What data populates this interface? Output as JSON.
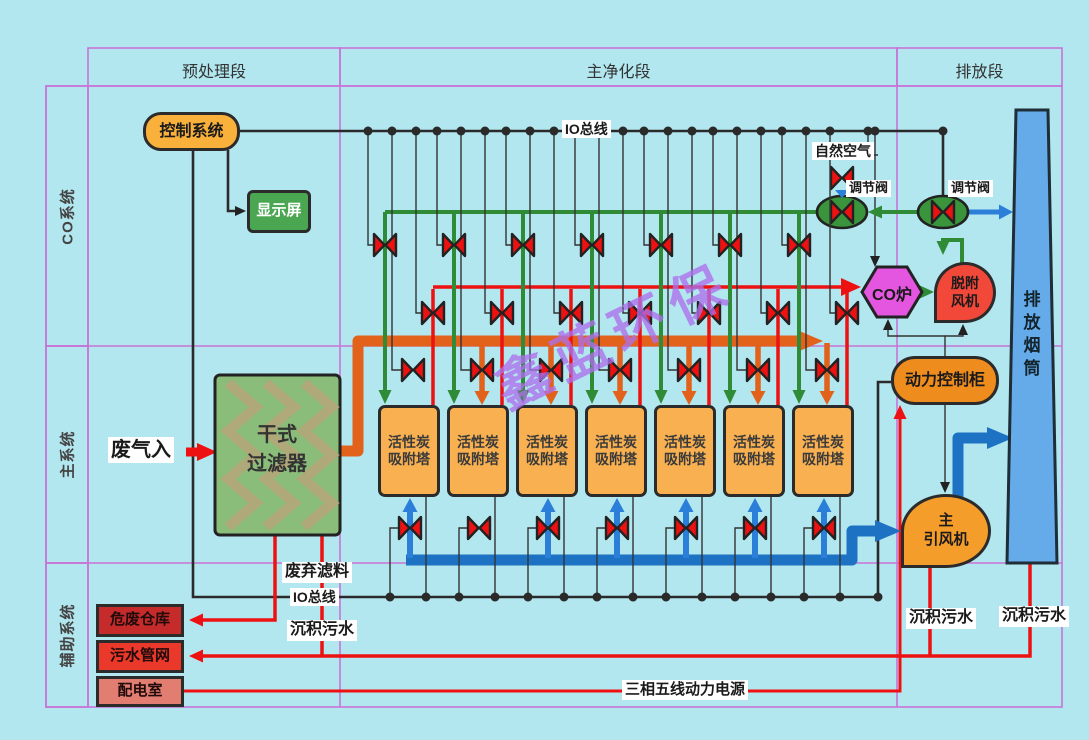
{
  "header": {
    "col1": "预处理段",
    "col2": "主净化段",
    "col3": "排放段"
  },
  "rows": {
    "row1": "CO系统",
    "row2": "主系统",
    "row3": "辅助系统"
  },
  "nodes": {
    "control_system": "控制系统",
    "display_screen": "显示屏",
    "dry_filter_line1": "干式",
    "dry_filter_line2": "过滤器",
    "co_furnace": "CO炉",
    "desorption_fan_line1": "脱附",
    "desorption_fan_line2": "风机",
    "power_cabinet": "动力控制柜",
    "main_fan_line1": "主",
    "main_fan_line2": "引风机",
    "stack": "排放烟筒",
    "hazard_store": "危废仓库",
    "sewage_network": "污水管网",
    "power_room": "配电室"
  },
  "towers": [
    {
      "line1": "活性炭",
      "line2": "吸附塔"
    },
    {
      "line1": "活性炭",
      "line2": "吸附塔"
    },
    {
      "line1": "活性炭",
      "line2": "吸附塔"
    },
    {
      "line1": "活性炭",
      "line2": "吸附塔"
    },
    {
      "line1": "活性炭",
      "line2": "吸附塔"
    },
    {
      "line1": "活性炭",
      "line2": "吸附塔"
    },
    {
      "line1": "活性炭",
      "line2": "吸附塔"
    }
  ],
  "labels": {
    "io_bus_top": "IO总线",
    "io_bus_bottom": "IO总线",
    "natural_air": "自然空气",
    "reg_valve_left": "调节阀",
    "reg_valve_right": "调节阀",
    "waste_gas_in": "废气入",
    "waste_filter_material": "废弃滤料",
    "sediment_sewage_left": "沉积污水",
    "sediment_sewage_mid": "沉积污水",
    "sediment_sewage_right": "沉积污水",
    "power_supply_line": "三相五线动力电源",
    "watermark": "鑫蓝环保"
  },
  "colors": {
    "background": "#b2e7f0",
    "grid_purple": "#c973d6",
    "pipe_orange": "#e2611b",
    "pipe_blue": "#1d72c4",
    "pipe_green": "#2f8b35",
    "pipe_red": "#ee1111",
    "tower_fill": "#f9b051",
    "furnace_magenta": "#e455e0",
    "stack_blue": "#66abe9"
  }
}
